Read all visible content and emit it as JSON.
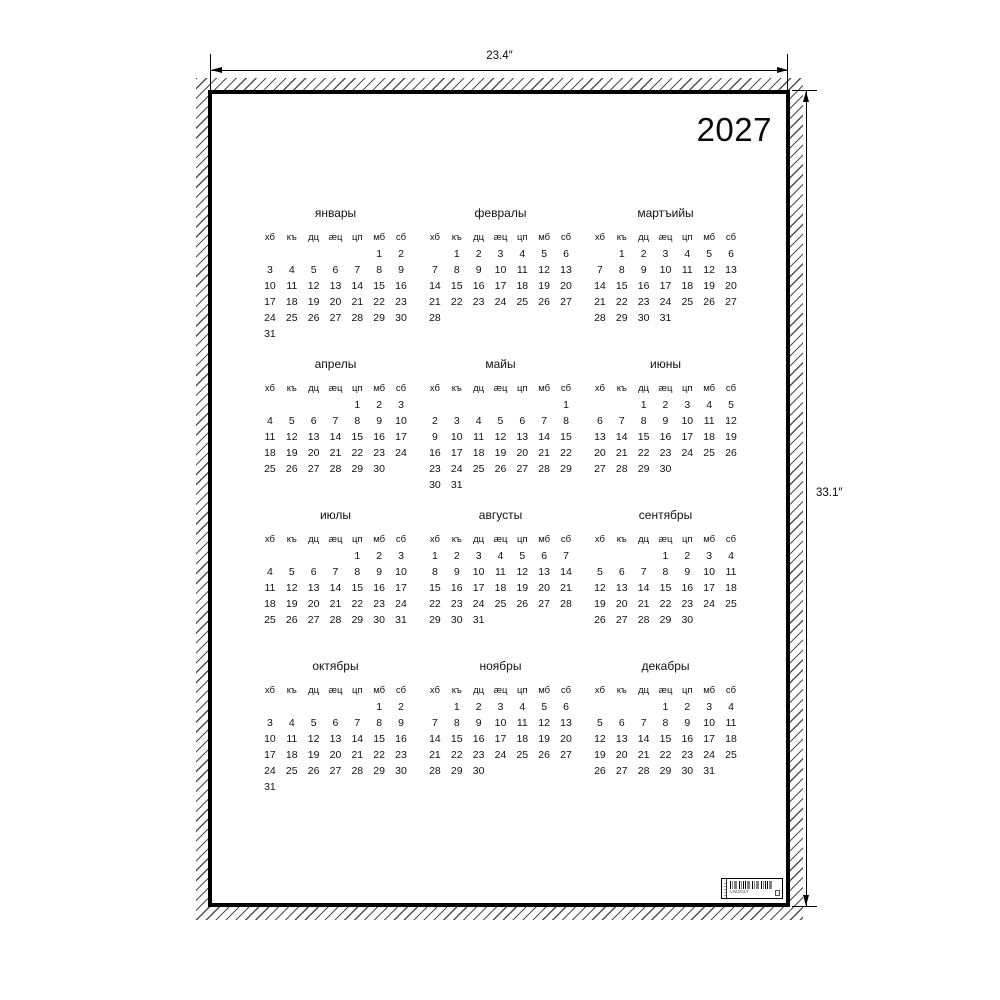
{
  "poster": {
    "year": "2027",
    "weekday_headers": [
      "хб",
      "къ",
      "дц",
      "æц",
      "цп",
      "мб",
      "сб"
    ],
    "months": [
      {
        "name": "январы",
        "weeks": [
          [
            "",
            "",
            "",
            "",
            "",
            "1",
            "2"
          ],
          [
            "3",
            "4",
            "5",
            "6",
            "7",
            "8",
            "9"
          ],
          [
            "10",
            "11",
            "12",
            "13",
            "14",
            "15",
            "16"
          ],
          [
            "17",
            "18",
            "19",
            "20",
            "21",
            "22",
            "23"
          ],
          [
            "24",
            "25",
            "26",
            "27",
            "28",
            "29",
            "30"
          ],
          [
            "31",
            "",
            "",
            "",
            "",
            "",
            ""
          ]
        ]
      },
      {
        "name": "февралы",
        "weeks": [
          [
            "",
            "1",
            "2",
            "3",
            "4",
            "5",
            "6"
          ],
          [
            "7",
            "8",
            "9",
            "10",
            "11",
            "12",
            "13"
          ],
          [
            "14",
            "15",
            "16",
            "17",
            "18",
            "19",
            "20"
          ],
          [
            "21",
            "22",
            "23",
            "24",
            "25",
            "26",
            "27"
          ],
          [
            "28",
            "",
            "",
            "",
            "",
            "",
            ""
          ]
        ]
      },
      {
        "name": "мартъийы",
        "weeks": [
          [
            "",
            "1",
            "2",
            "3",
            "4",
            "5",
            "6"
          ],
          [
            "7",
            "8",
            "9",
            "10",
            "11",
            "12",
            "13"
          ],
          [
            "14",
            "15",
            "16",
            "17",
            "18",
            "19",
            "20"
          ],
          [
            "21",
            "22",
            "23",
            "24",
            "25",
            "26",
            "27"
          ],
          [
            "28",
            "29",
            "30",
            "31",
            "",
            "",
            ""
          ]
        ]
      },
      {
        "name": "апрелы",
        "weeks": [
          [
            "",
            "",
            "",
            "",
            "1",
            "2",
            "3"
          ],
          [
            "4",
            "5",
            "6",
            "7",
            "8",
            "9",
            "10"
          ],
          [
            "11",
            "12",
            "13",
            "14",
            "15",
            "16",
            "17"
          ],
          [
            "18",
            "19",
            "20",
            "21",
            "22",
            "23",
            "24"
          ],
          [
            "25",
            "26",
            "27",
            "28",
            "29",
            "30",
            ""
          ]
        ]
      },
      {
        "name": "майы",
        "weeks": [
          [
            "",
            "",
            "",
            "",
            "",
            "",
            "1"
          ],
          [
            "2",
            "3",
            "4",
            "5",
            "6",
            "7",
            "8"
          ],
          [
            "9",
            "10",
            "11",
            "12",
            "13",
            "14",
            "15"
          ],
          [
            "16",
            "17",
            "18",
            "19",
            "20",
            "21",
            "22"
          ],
          [
            "23",
            "24",
            "25",
            "26",
            "27",
            "28",
            "29"
          ],
          [
            "30",
            "31",
            "",
            "",
            "",
            "",
            ""
          ]
        ]
      },
      {
        "name": "июны",
        "weeks": [
          [
            "",
            "",
            "1",
            "2",
            "3",
            "4",
            "5"
          ],
          [
            "6",
            "7",
            "8",
            "9",
            "10",
            "11",
            "12"
          ],
          [
            "13",
            "14",
            "15",
            "16",
            "17",
            "18",
            "19"
          ],
          [
            "20",
            "21",
            "22",
            "23",
            "24",
            "25",
            "26"
          ],
          [
            "27",
            "28",
            "29",
            "30",
            "",
            "",
            ""
          ]
        ]
      },
      {
        "name": "июлы",
        "weeks": [
          [
            "",
            "",
            "",
            "",
            "1",
            "2",
            "3"
          ],
          [
            "4",
            "5",
            "6",
            "7",
            "8",
            "9",
            "10"
          ],
          [
            "11",
            "12",
            "13",
            "14",
            "15",
            "16",
            "17"
          ],
          [
            "18",
            "19",
            "20",
            "21",
            "22",
            "23",
            "24"
          ],
          [
            "25",
            "26",
            "27",
            "28",
            "29",
            "30",
            "31"
          ]
        ]
      },
      {
        "name": "августы",
        "weeks": [
          [
            "1",
            "2",
            "3",
            "4",
            "5",
            "6",
            "7"
          ],
          [
            "8",
            "9",
            "10",
            "11",
            "12",
            "13",
            "14"
          ],
          [
            "15",
            "16",
            "17",
            "18",
            "19",
            "20",
            "21"
          ],
          [
            "22",
            "23",
            "24",
            "25",
            "26",
            "27",
            "28"
          ],
          [
            "29",
            "30",
            "31",
            "",
            "",
            "",
            ""
          ]
        ]
      },
      {
        "name": "сентябры",
        "weeks": [
          [
            "",
            "",
            "",
            "1",
            "2",
            "3",
            "4"
          ],
          [
            "5",
            "6",
            "7",
            "8",
            "9",
            "10",
            "11"
          ],
          [
            "12",
            "13",
            "14",
            "15",
            "16",
            "17",
            "18"
          ],
          [
            "19",
            "20",
            "21",
            "22",
            "23",
            "24",
            "25"
          ],
          [
            "26",
            "27",
            "28",
            "29",
            "30",
            "",
            ""
          ]
        ]
      },
      {
        "name": "октябры",
        "weeks": [
          [
            "",
            "",
            "",
            "",
            "",
            "1",
            "2"
          ],
          [
            "3",
            "4",
            "5",
            "6",
            "7",
            "8",
            "9"
          ],
          [
            "10",
            "11",
            "12",
            "13",
            "14",
            "15",
            "16"
          ],
          [
            "17",
            "18",
            "19",
            "20",
            "21",
            "22",
            "23"
          ],
          [
            "24",
            "25",
            "26",
            "27",
            "28",
            "29",
            "30"
          ],
          [
            "31",
            "",
            "",
            "",
            "",
            "",
            ""
          ]
        ]
      },
      {
        "name": "ноябры",
        "weeks": [
          [
            "",
            "1",
            "2",
            "3",
            "4",
            "5",
            "6"
          ],
          [
            "7",
            "8",
            "9",
            "10",
            "11",
            "12",
            "13"
          ],
          [
            "14",
            "15",
            "16",
            "17",
            "18",
            "19",
            "20"
          ],
          [
            "21",
            "22",
            "23",
            "24",
            "25",
            "26",
            "27"
          ],
          [
            "28",
            "29",
            "30",
            "",
            "",
            "",
            ""
          ]
        ]
      },
      {
        "name": "декабры",
        "weeks": [
          [
            "",
            "",
            "",
            "1",
            "2",
            "3",
            "4"
          ],
          [
            "5",
            "6",
            "7",
            "8",
            "9",
            "10",
            "11"
          ],
          [
            "12",
            "13",
            "14",
            "15",
            "16",
            "17",
            "18"
          ],
          [
            "19",
            "20",
            "21",
            "22",
            "23",
            "24",
            "25"
          ],
          [
            "26",
            "27",
            "28",
            "29",
            "30",
            "31",
            ""
          ]
        ]
      }
    ],
    "barcode": {
      "code": "LW2027"
    }
  },
  "dimension_annotations": {
    "width": "23.4″",
    "height": "33.1″"
  },
  "colors": {
    "ink": "#000000",
    "paper": "#ffffff"
  }
}
